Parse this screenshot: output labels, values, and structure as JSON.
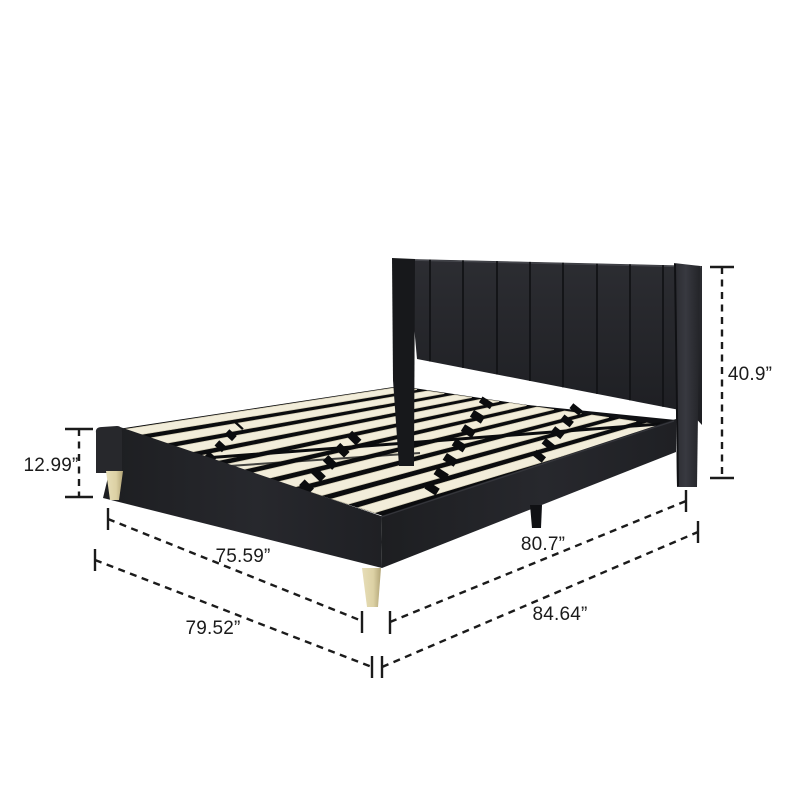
{
  "illustration": {
    "type": "product-dimension-diagram",
    "subject": "upholstered platform bed frame with wingback headboard, wood slats and tapered legs"
  },
  "measurements": {
    "side_rail_height": {
      "label": "12.99”"
    },
    "headboard_height": {
      "label": "40.9”"
    },
    "frame_width": {
      "label": "75.59”"
    },
    "overall_width": {
      "label": "79.52”"
    },
    "frame_length": {
      "label": "80.7”"
    },
    "overall_length": {
      "label": "84.64”"
    }
  },
  "colors": {
    "background": "#ffffff",
    "bed_fabric": "#222327",
    "bed_fabric_light": "#35363b",
    "platform_black": "#0b0c0e",
    "slats": "#f2edda",
    "slat_edge": "#d6cfb6",
    "legs_wood": "#dcd1a4",
    "legs_wood_shadow": "#b2a577",
    "dimension_lines": "#1b1b1b"
  }
}
